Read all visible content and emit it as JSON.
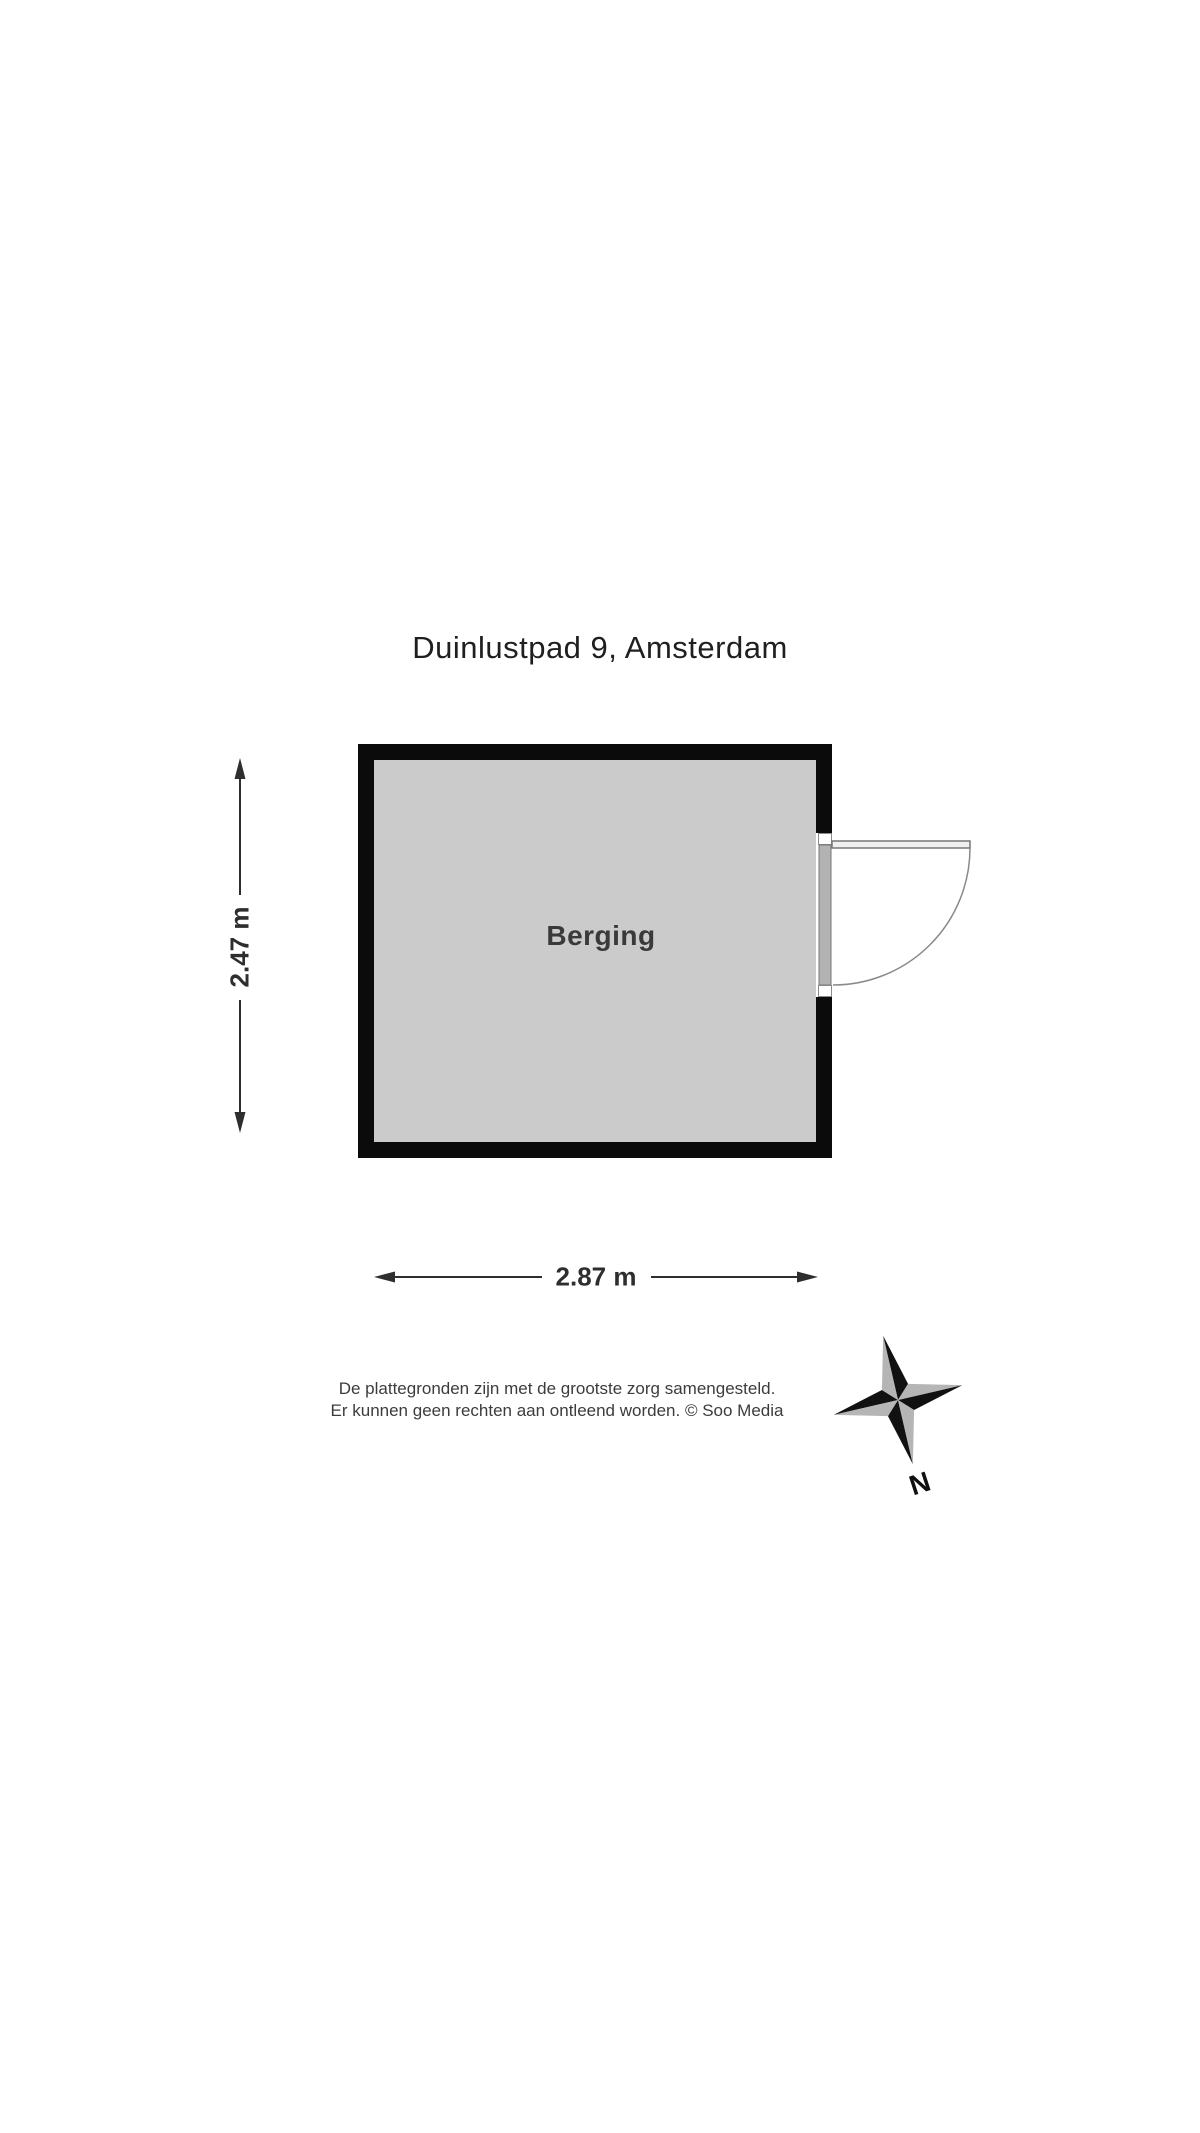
{
  "page": {
    "title": "Duinlustpad 9, Amsterdam"
  },
  "floor_plan": {
    "room": {
      "label": "Berging"
    },
    "dimensions": {
      "height_label": "2.47 m",
      "width_label": "2.87 m"
    }
  },
  "compass": {
    "north_label": "N"
  },
  "disclaimer": {
    "line1": "De plattegronden zijn met de grootste zorg samengesteld.",
    "line2": "Er kunnen geen rechten aan ontleend worden. © Soo Media"
  },
  "colors": {
    "background": "#ffffff",
    "wall": "#0b0b0b",
    "room_fill": "#cbcbcb",
    "door_frame": "#b3b3b3",
    "door_frame_border": "#777777",
    "door_swing_line": "#8a8a8a",
    "dimension_line": "#2e2e2e",
    "compass_dark": "#111111",
    "compass_light": "#b5b5b5",
    "text_primary": "#1f1f1f",
    "text_secondary": "#3c3c3c"
  }
}
